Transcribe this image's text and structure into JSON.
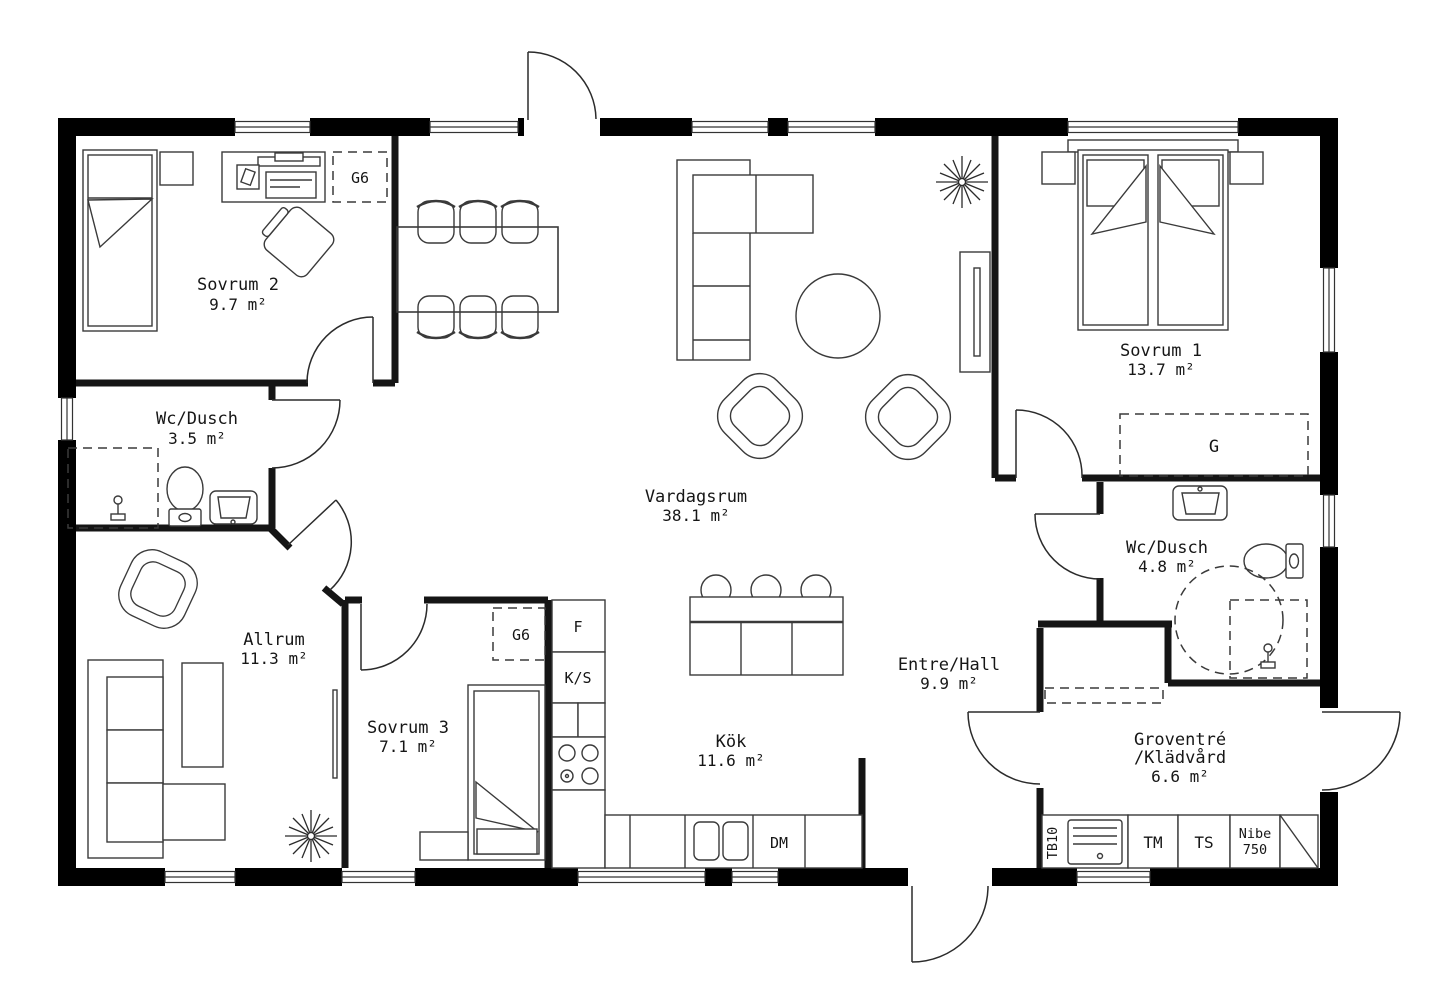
{
  "rooms": {
    "sovrum2": {
      "name": "Sovrum 2",
      "area": "9.7 m²"
    },
    "wc_dusch2": {
      "name": "Wc/Dusch",
      "area": "3.5 m²"
    },
    "allrum": {
      "name": "Allrum",
      "area": "11.3 m²"
    },
    "sovrum3": {
      "name": "Sovrum 3",
      "area": "7.1 m²"
    },
    "vardagsrum": {
      "name": "Vardagsrum",
      "area": "38.1 m²"
    },
    "kok": {
      "name": "Kök",
      "area": "11.6 m²"
    },
    "entre_hall": {
      "name": "Entre/Hall",
      "area": "9.9 m²"
    },
    "sovrum1": {
      "name": "Sovrum 1",
      "area": "13.7 m²"
    },
    "wc_dusch1": {
      "name": "Wc/Dusch",
      "area": "4.8 m²"
    },
    "groventre": {
      "name_line1": "Groventré",
      "name_line2": "/Klädvård",
      "area": "6.6 m²"
    }
  },
  "fixtures": {
    "wardrobe_g6": "G6",
    "wardrobe_g": "G",
    "fridge": "F",
    "pantry": "K/S",
    "dishwasher": "DM",
    "washing_machine": "TM",
    "drying_cabinet": "TS",
    "heat_pump_line1": "Nibe",
    "heat_pump_line2": "750",
    "utility_sink": "TB10"
  },
  "colors": {
    "wall": "#000000",
    "furniture_line": "#3a3a3a",
    "background": "#ffffff"
  }
}
